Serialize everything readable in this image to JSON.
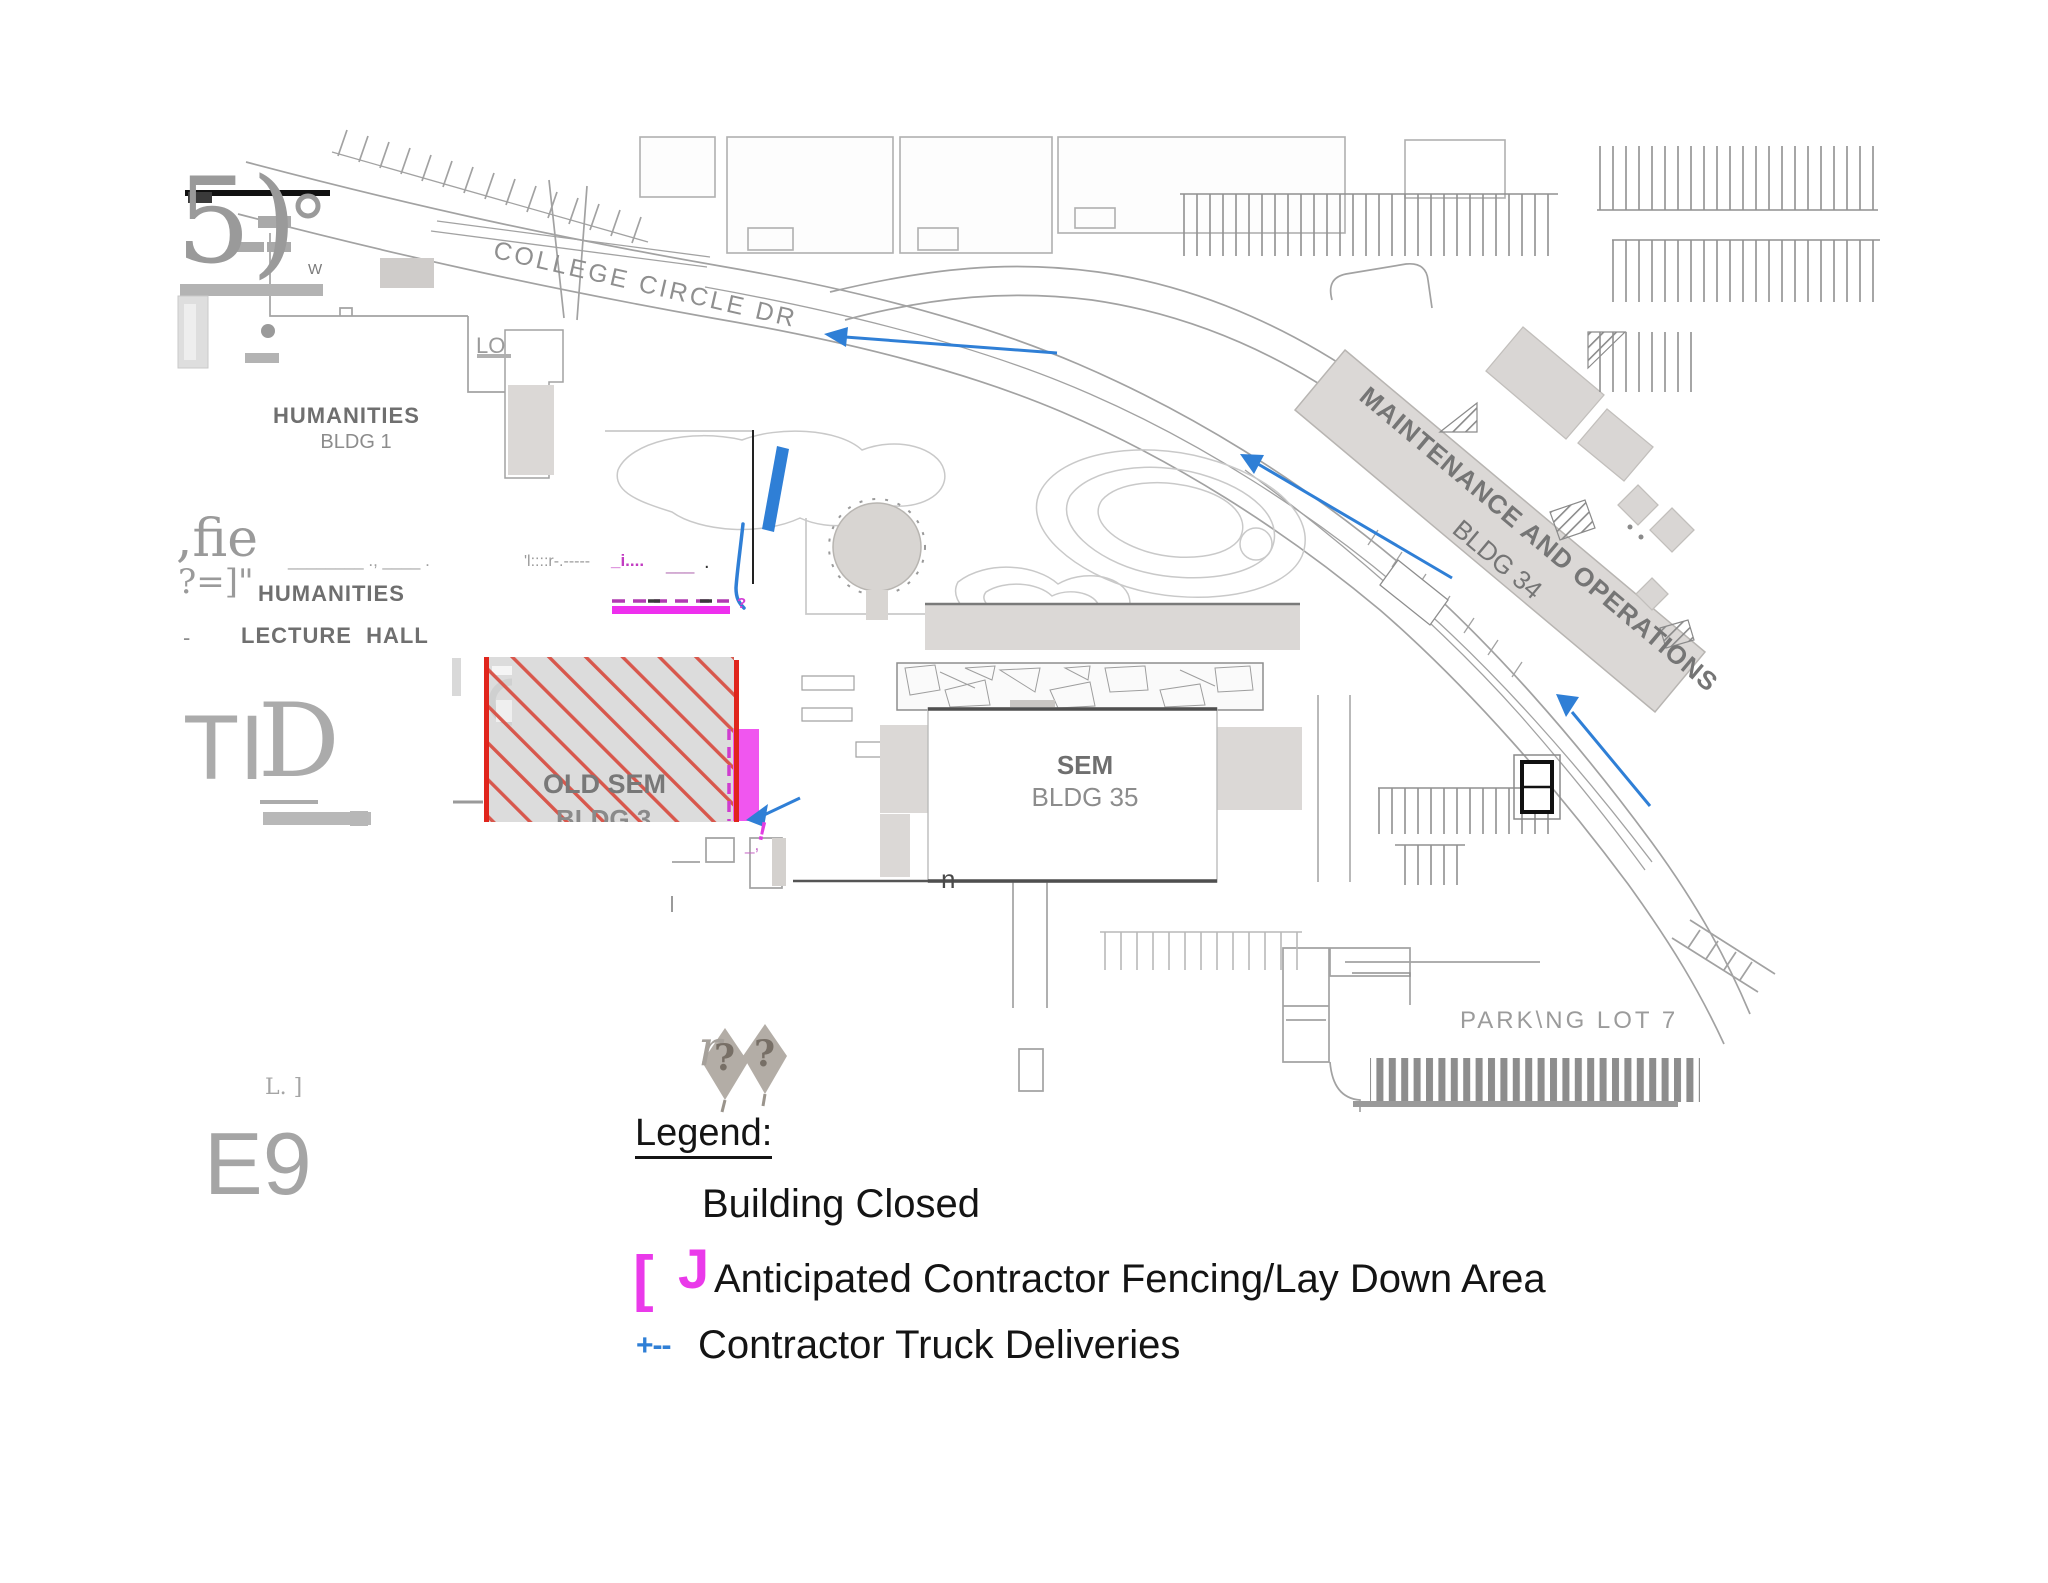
{
  "map": {
    "road_label": "COLLEGE CIRCLE DR",
    "buildings": {
      "humanities1": {
        "line1": "HUMANITIES",
        "line2": "BLDG 1"
      },
      "humanities_lecture": {
        "dash": "-",
        "line1": "HUMANITIES",
        "line2": "LECTURE  HALL"
      },
      "old_sem": {
        "line1": "OLD SEM",
        "line2": "BLDG 3"
      },
      "sem": {
        "line1": "SEM",
        "line2": "BLDG 35"
      },
      "maintenance": {
        "line1": "MAINTENANCE AND OPERATIONS",
        "line2": "BLDG 34"
      }
    },
    "parking_lot_label": "PARK\\NG LOT 7",
    "lo_mark": "LO",
    "w_mark": "W"
  },
  "legend": {
    "title": "Legend:",
    "items": [
      {
        "label": "Building Closed"
      },
      {
        "swatch_left": "[",
        "swatch_right": "J",
        "label": "Anticipated Contractor Fencing/Lay Down Area"
      },
      {
        "swatch": "+--",
        "label": "Contractor Truck Deliveries"
      }
    ]
  },
  "artifacts": {
    "a_5paren": "5)",
    "a_fie": ",fie",
    "a_bracket": "?=]\"",
    "a_underscores": "________ ., ____ .",
    "a_noise": "'l::::r-.-----",
    "a_noise_m": "_i....",
    "a_noise_m2": "___",
    "a_noise_dot": ".",
    "a_ti": "TI",
    "a_d": "D",
    "a_lj": "L. ]",
    "a_e9": "E9",
    "a_r": "r",
    "a_q1": "?",
    "a_q2": "?",
    "a_n": "n",
    "a_qm": "?",
    "a_excl": "!",
    "a_uscomma": "_,",
    "a_tick": "|"
  },
  "colors": {
    "closed_red": "#e0251c",
    "hatch_red": "#d8574c",
    "fence_magenta": "#ee2fee",
    "truck_blue": "#2f7fd6",
    "map_gray": "#9a9a9a",
    "building_gray": "#d9d6d4",
    "label_gray": "#6f6f6f"
  }
}
